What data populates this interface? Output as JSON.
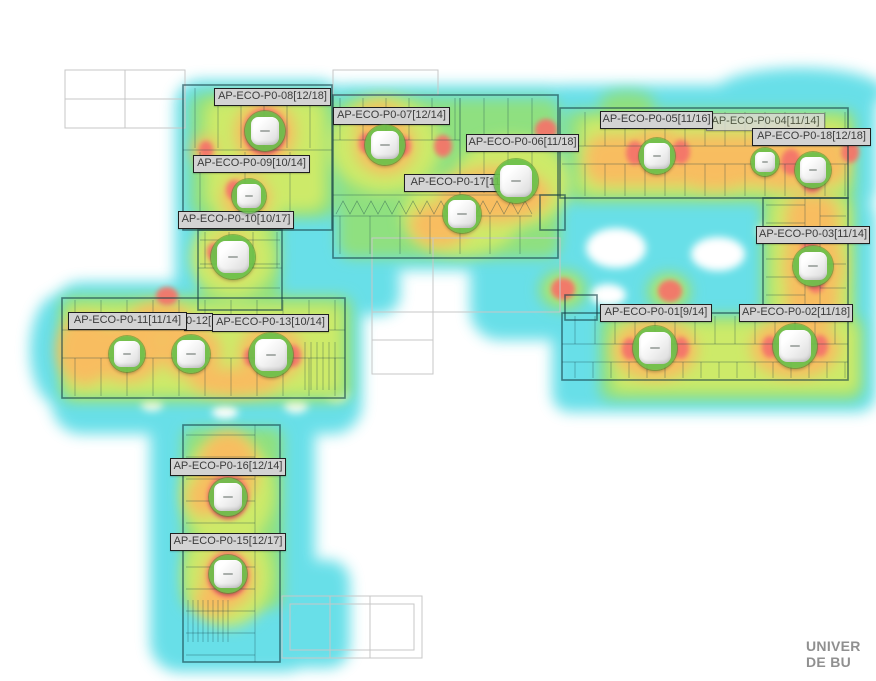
{
  "canvas": {
    "width": 876,
    "height": 681,
    "description_visible_text_only": true
  },
  "watermark": {
    "line1": "UNIVER",
    "line2": "DE BU"
  },
  "palette": {
    "coverage_weak_cyan": "#59dce6",
    "coverage_fair_green": "#8fe080",
    "coverage_good_yellowgreen": "#cdea69",
    "coverage_strong_orange": "#f8bd60",
    "coverage_max_red": "#f4756b",
    "ap_ring_green": "#69c04b",
    "label_bg": "#d3d3d3",
    "label_border": "#1f1f1f",
    "label_text": "#3b3b3b",
    "plan_line": "#143c46",
    "plan_faint_line": "#c7c7c7",
    "watermark_text": "#909090"
  },
  "access_points": [
    {
      "id": "AP-ECO-P0-12",
      "label": "0-12[",
      "truncated": true,
      "lx": 184,
      "ly": 313,
      "lw": 29,
      "ax": 191,
      "ay": 354,
      "size": 38
    },
    {
      "id": "AP-ECO-P0-04",
      "label": "AP-ECO-P0-04[11/14]",
      "dim": true,
      "lx": 706,
      "ly": 113,
      "lw": 119,
      "ax": 765,
      "ay": 162,
      "size": 28
    },
    {
      "id": "AP-ECO-P0-05",
      "label": "AP-ECO-P0-05[11/16]",
      "lx": 600,
      "ly": 111,
      "lw": 113,
      "ax": 657,
      "ay": 156,
      "size": 36
    },
    {
      "id": "AP-ECO-P0-18",
      "label": "AP-ECO-P0-18[12/18]",
      "lx": 752,
      "ly": 128,
      "lw": 119,
      "ax": 813,
      "ay": 170,
      "size": 36
    },
    {
      "id": "AP-ECO-P0-08",
      "label": "AP-ECO-P0-08[12/18]",
      "lx": 214,
      "ly": 88,
      "lw": 117,
      "ax": 265,
      "ay": 131,
      "size": 40
    },
    {
      "id": "AP-ECO-P0-07",
      "label": "AP-ECO-P0-07[12/14]",
      "lx": 333,
      "ly": 107,
      "lw": 117,
      "ax": 385,
      "ay": 145,
      "size": 40
    },
    {
      "id": "AP-ECO-P0-09",
      "label": "AP-ECO-P0-09[10/14]",
      "lx": 193,
      "ly": 155,
      "lw": 117,
      "ax": 249,
      "ay": 196,
      "size": 34
    },
    {
      "id": "AP-ECO-P0-10",
      "label": "AP-ECO-P0-10[10/17]",
      "lx": 178,
      "ly": 211,
      "lw": 116,
      "ax": 233,
      "ay": 257,
      "size": 44
    },
    {
      "id": "AP-ECO-P0-06",
      "label": "AP-ECO-P0-06[11/18]",
      "lx": 466,
      "ly": 134,
      "lw": 113,
      "ax": 516,
      "ay": 181,
      "size": 44
    },
    {
      "id": "AP-ECO-P0-17",
      "label": "AP-ECO-P0-17[11/1",
      "truncated": true,
      "lx": 404,
      "ly": 174,
      "lw": 112,
      "ax": 462,
      "ay": 214,
      "size": 38
    },
    {
      "id": "AP-ECO-P0-03",
      "label": "AP-ECO-P0-03[11/14]",
      "lx": 756,
      "ly": 226,
      "lw": 114,
      "ax": 813,
      "ay": 266,
      "size": 40
    },
    {
      "id": "AP-ECO-P0-01",
      "label": "AP-ECO-P0-01[9/14]",
      "lx": 600,
      "ly": 304,
      "lw": 112,
      "ax": 655,
      "ay": 348,
      "size": 44
    },
    {
      "id": "AP-ECO-P0-02",
      "label": "AP-ECO-P0-02[11/18]",
      "lx": 739,
      "ly": 304,
      "lw": 114,
      "ax": 795,
      "ay": 346,
      "size": 44
    },
    {
      "id": "AP-ECO-P0-11",
      "label": "AP-ECO-P0-11[11/14]",
      "lx": 68,
      "ly": 312,
      "lw": 119,
      "ax": 127,
      "ay": 354,
      "size": 36
    },
    {
      "id": "AP-ECO-P0-13",
      "label": "AP-ECO-P0-13[10/14]",
      "lx": 212,
      "ly": 314,
      "lw": 117,
      "ax": 271,
      "ay": 355,
      "size": 44
    },
    {
      "id": "AP-ECO-P0-16",
      "label": "AP-ECO-P0-16[12/14]",
      "lx": 170,
      "ly": 458,
      "lw": 116,
      "ax": 228,
      "ay": 497,
      "size": 38
    },
    {
      "id": "AP-ECO-P0-15",
      "label": "AP-ECO-P0-15[12/17]",
      "lx": 170,
      "ly": 533,
      "lw": 116,
      "ax": 228,
      "ay": 574,
      "size": 38
    }
  ]
}
